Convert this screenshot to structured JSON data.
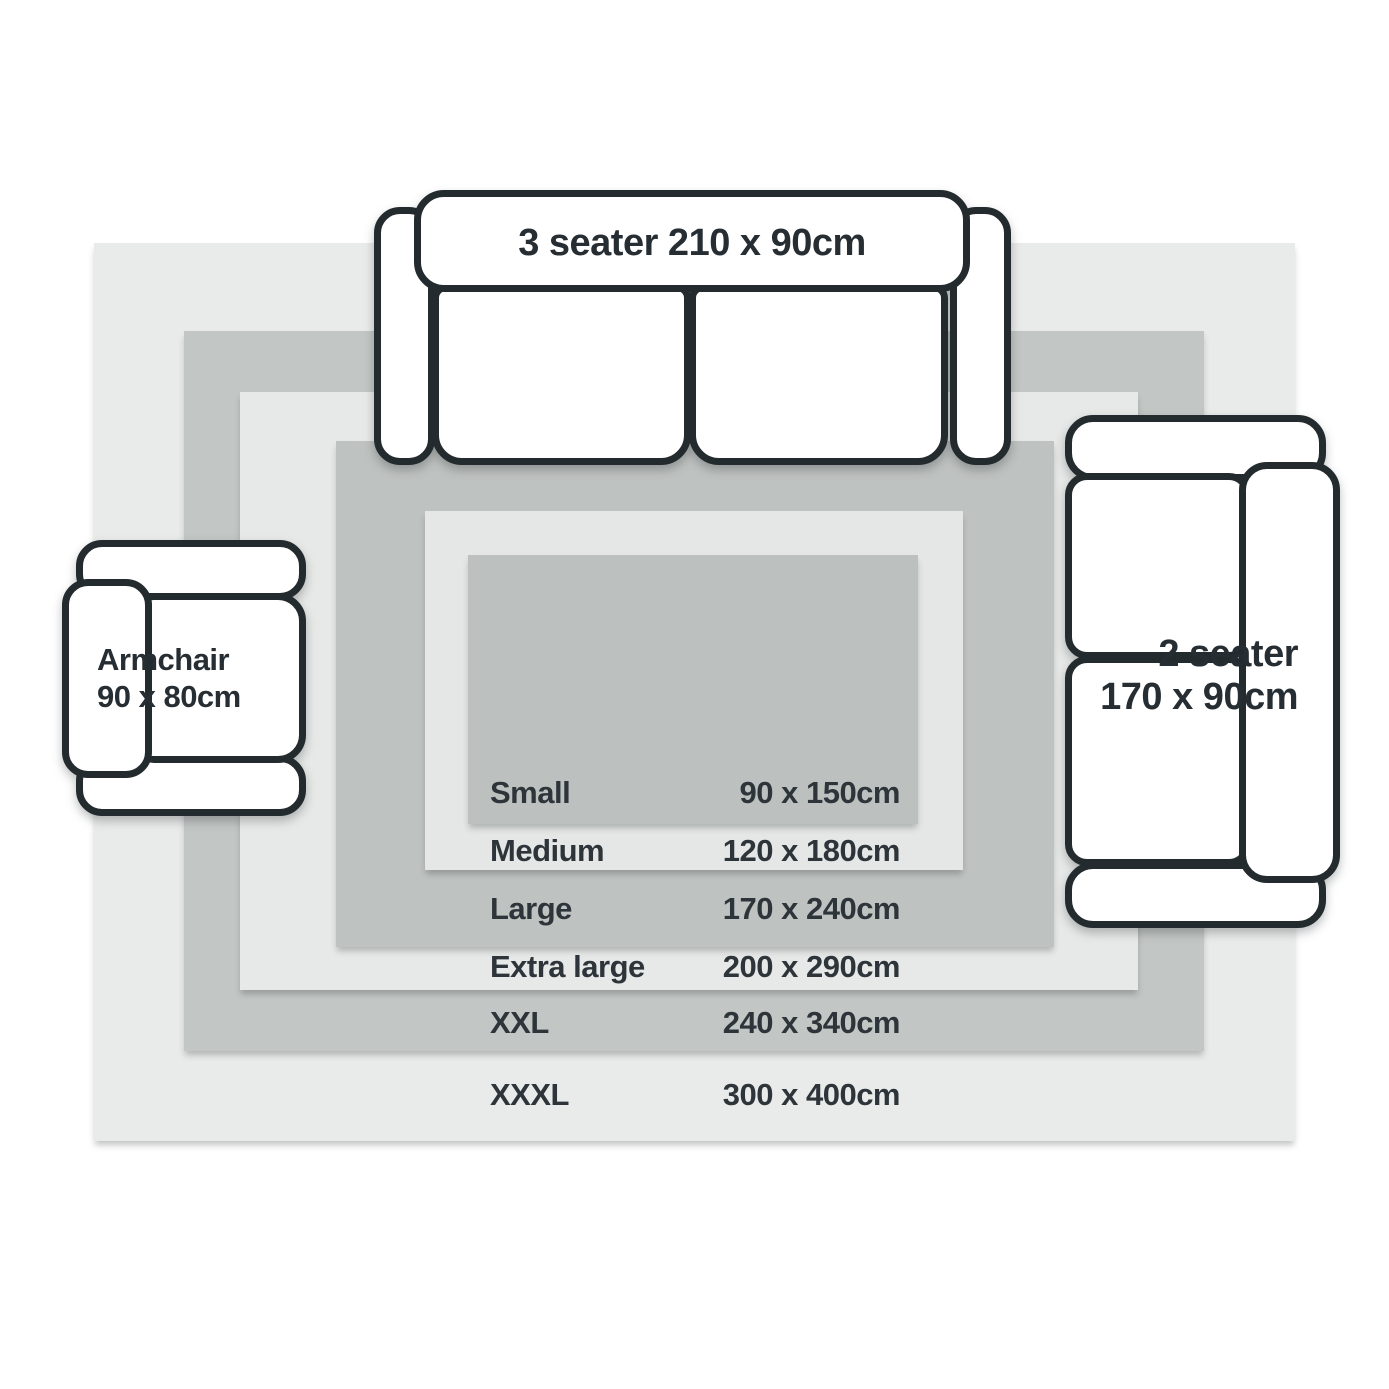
{
  "sizes": [
    {
      "name": "Small",
      "dimensions": "90 x 150cm",
      "swatch": "#bcc0be"
    },
    {
      "name": "Medium",
      "dimensions": "120 x 180cm",
      "swatch": "#e5e7e6"
    },
    {
      "name": "Large",
      "dimensions": "170 x 240cm",
      "swatch": "#bec2c0"
    },
    {
      "name": "Extra large",
      "dimensions": "200 x 290cm",
      "swatch": "#e7e9e8"
    },
    {
      "name": "XXL",
      "dimensions": "240 x 340cm",
      "swatch": "#c2c6c4"
    },
    {
      "name": "XXXL",
      "dimensions": "300 x 400cm",
      "swatch": "#e9ebea"
    }
  ],
  "furniture": {
    "sofa_3_seater": {
      "label": "3 seater 210 x 90cm"
    },
    "sofa_2_seater": {
      "line1": "2 seater",
      "line2": "170 x 90cm"
    },
    "armchair": {
      "line1": "Armchair",
      "line2": "90 x 80cm"
    }
  },
  "colors": {
    "outline": "#242b2e",
    "text": "#2e353a",
    "furniture_fill": "#ffffff",
    "background": "#ffffff"
  }
}
